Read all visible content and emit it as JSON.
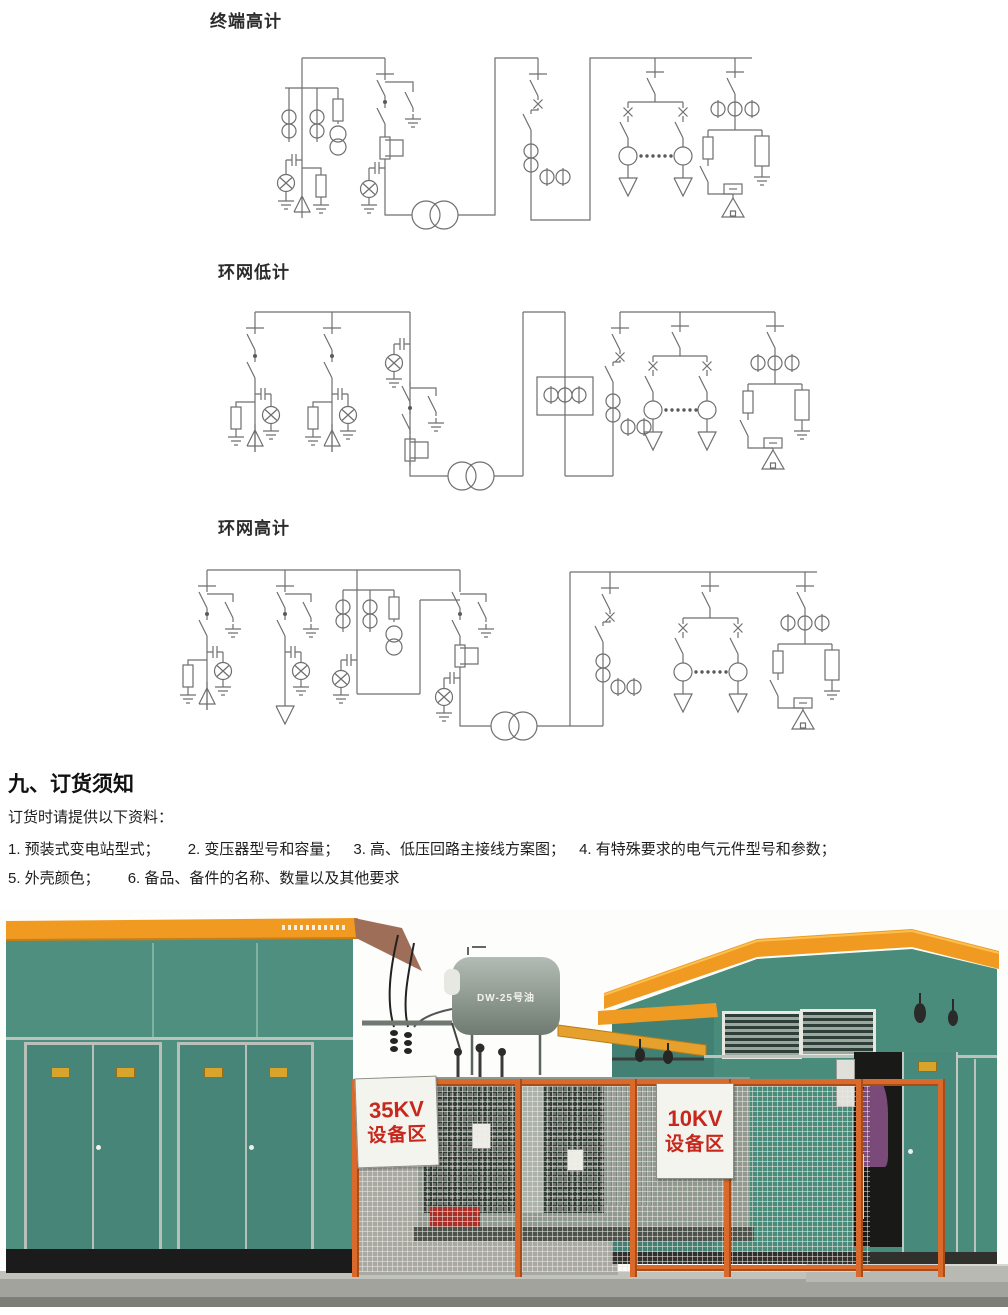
{
  "diagrams": {
    "terminal_high": {
      "label": "终端高计"
    },
    "ring_low": {
      "label": "环网低计"
    },
    "ring_high": {
      "label": "环网高计"
    }
  },
  "ordering": {
    "heading": "九、订货须知",
    "intro": "订货时请提供以下资料：",
    "items": [
      "1. 预装式变电站型式；",
      "2. 变压器型号和容量；",
      "3. 高、低压回路主接线方案图；",
      "4. 有特殊要求的电气元件型号和参数；",
      "5. 外壳颜色；",
      "6. 备品、备件的名称、数量以及其他要求"
    ]
  },
  "photo": {
    "sign_35kv": {
      "line1": "35KV",
      "line2": "设备区"
    },
    "sign_10kv": {
      "line1": "10KV",
      "line2": "设备区"
    },
    "transformer_label": "DW-25号油",
    "colors": {
      "wall_green": "#4e8f7f",
      "roof_orange": "#f09a22",
      "fence_orange": "#d96a2c",
      "sign_text_red": "#c6281e",
      "concrete_gray": "#a3a39d",
      "plinth_black": "#1b1b1b"
    }
  }
}
